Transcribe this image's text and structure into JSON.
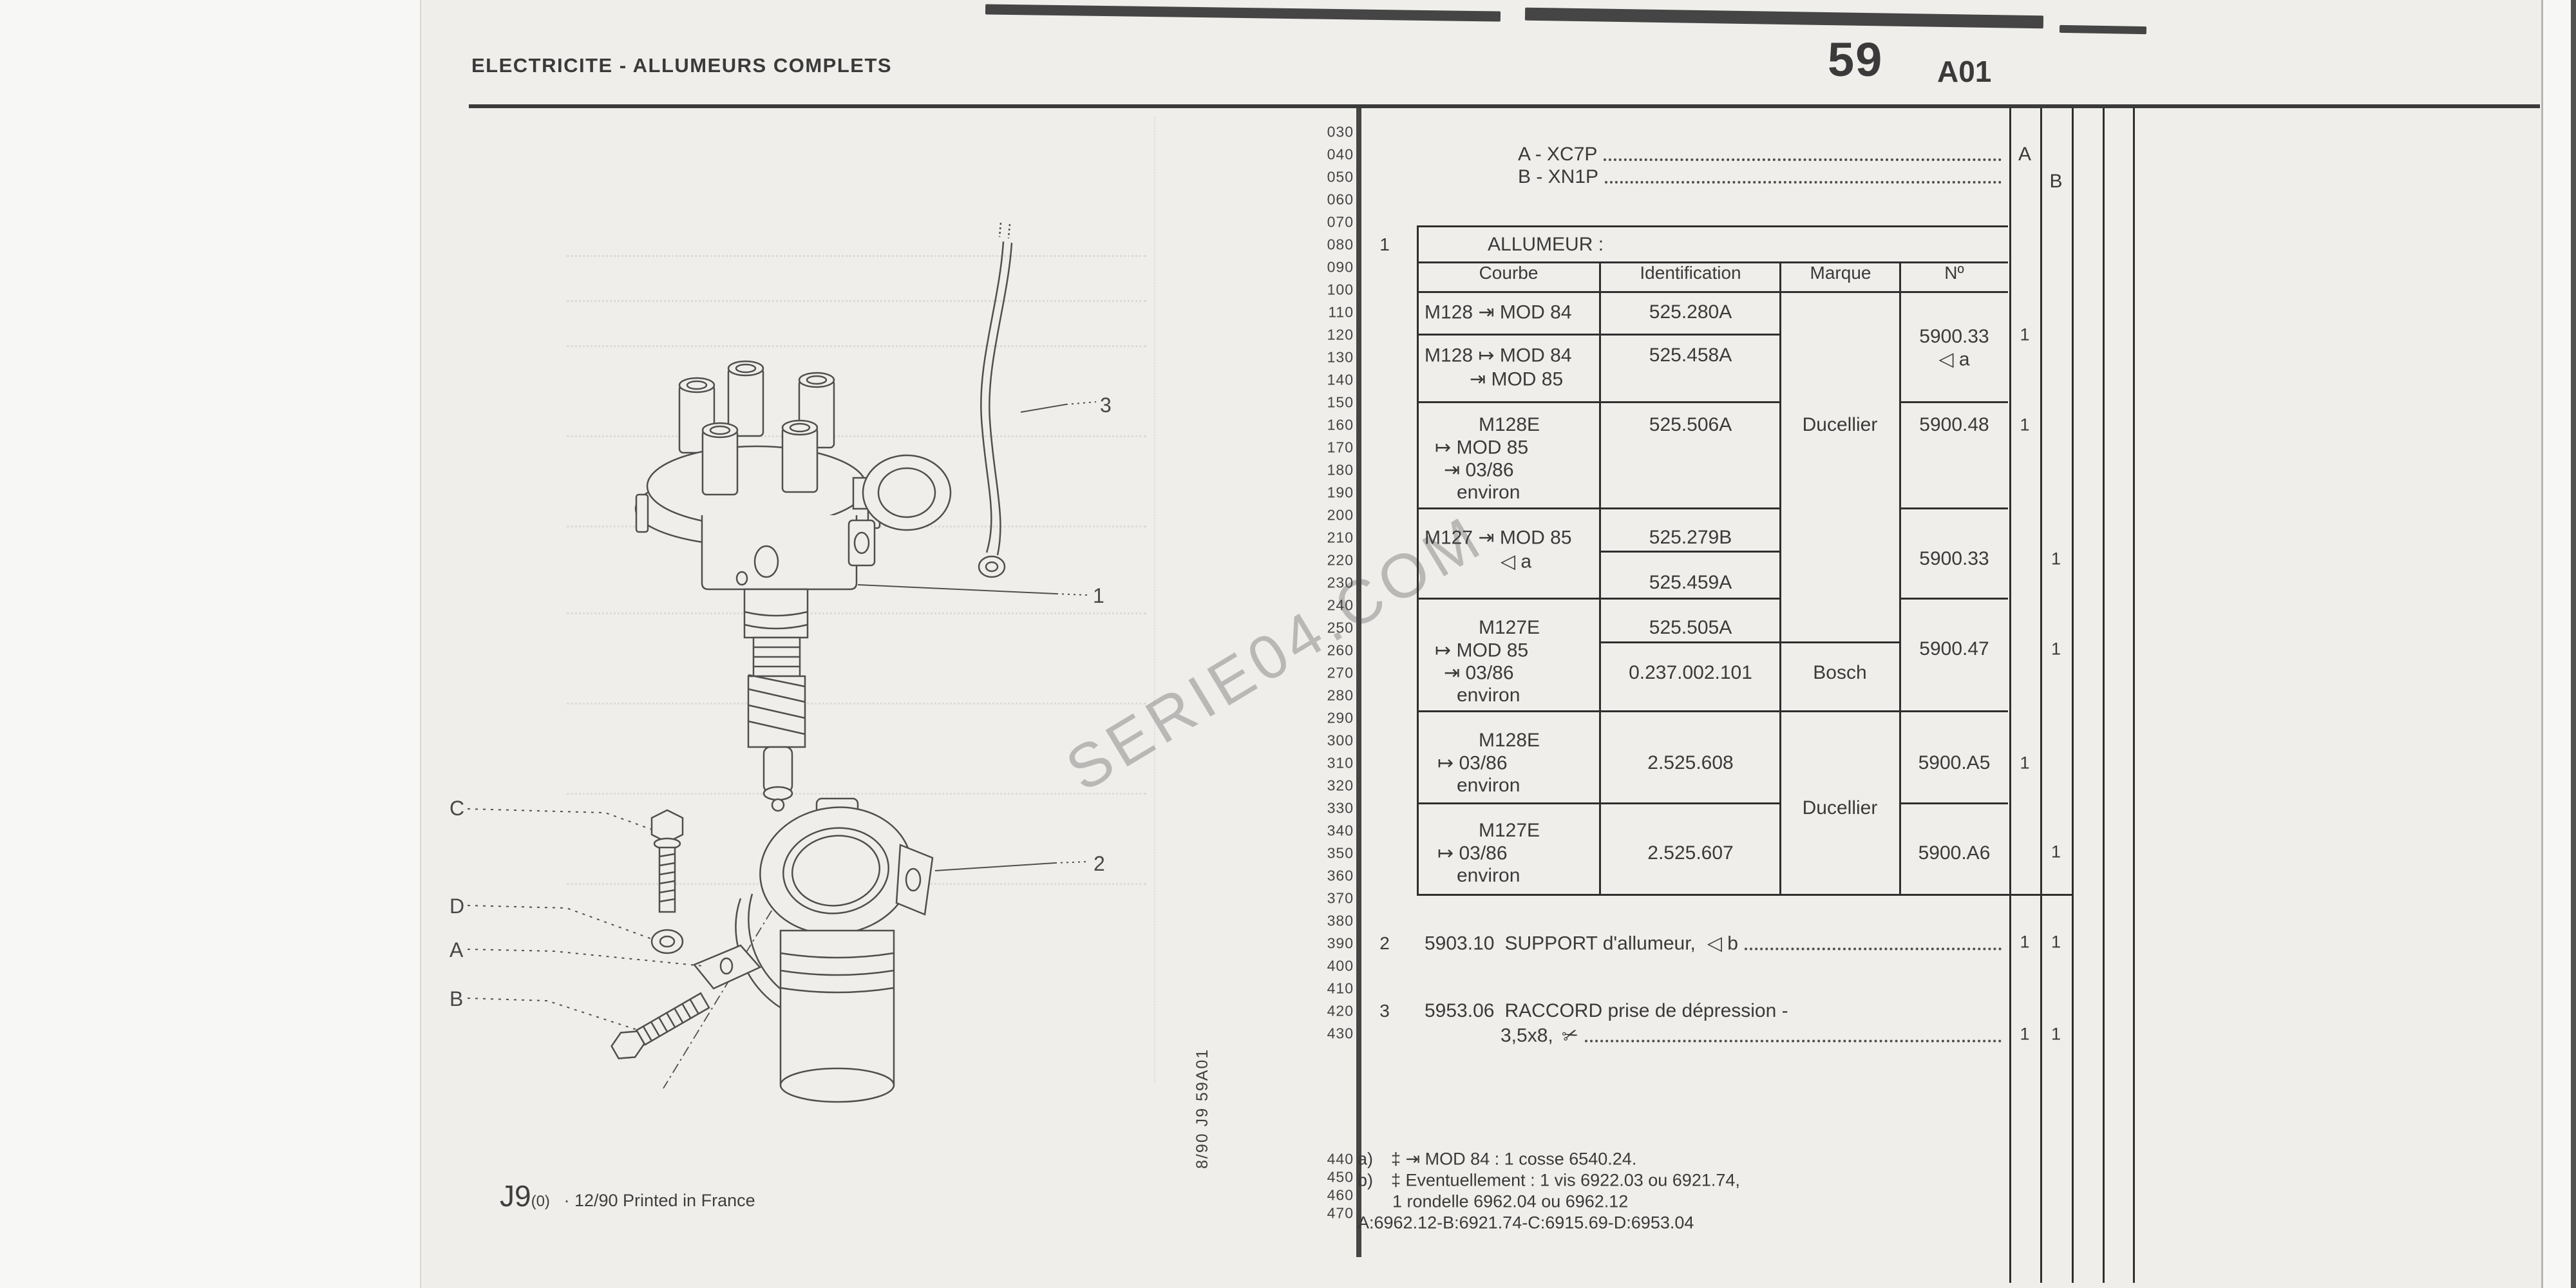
{
  "header": {
    "title": "ELECTRICITE - ALLUMEURS COMPLETS",
    "page_number": "59",
    "page_code": "A01"
  },
  "gutter": [
    "030",
    "040",
    "050",
    "060",
    "070",
    "080",
    "090",
    "100",
    "110",
    "120",
    "130",
    "140",
    "150",
    "160",
    "170",
    "180",
    "190",
    "200",
    "210",
    "220",
    "230",
    "240",
    "250",
    "260",
    "270",
    "280",
    "290",
    "300",
    "310",
    "320",
    "330",
    "340",
    "350",
    "360",
    "370",
    "380",
    "390",
    "400",
    "410",
    "420",
    "430"
  ],
  "gutter_bottom": [
    "440",
    "450",
    "460",
    "470"
  ],
  "variants": {
    "row_a": "A - XC7P",
    "row_b": "B - XN1P",
    "col_a": "A",
    "col_b": "B"
  },
  "allumeur": {
    "item_no": "1",
    "title": "ALLUMEUR :",
    "headers": {
      "courbe": "Courbe",
      "identification": "Identification",
      "marque": "Marque",
      "num": "Nº"
    },
    "rows": [
      {
        "c0": "M128 ⇥ MOD 84",
        "id0": "525.280A"
      },
      {
        "c0": "M128 ↦ MOD 84",
        "c1": "⇥ MOD 85",
        "id0": "525.458A",
        "num": "5900.33",
        "num_note": "◁ a",
        "qty_a": "1"
      },
      {
        "c0": "M128E",
        "c1": "↦ MOD 85",
        "c2": "⇥ 03/86",
        "c3": "environ",
        "id0": "525.506A",
        "marque": "Ducellier",
        "num": "5900.48",
        "qty_a": "1"
      },
      {
        "c0": "M127 ⇥ MOD 85",
        "c1": "◁ a",
        "id0": "525.279B",
        "id1": "525.459A",
        "num": "5900.33",
        "qty_b": "1"
      },
      {
        "c0": "M127E",
        "c1": "↦ MOD 85",
        "c2": "⇥ 03/86",
        "c3": "environ",
        "id0": "525.505A",
        "id1": "0.237.002.101",
        "marque": "Bosch",
        "num": "5900.47",
        "qty_b": "1"
      },
      {
        "c0": "M128E",
        "c1": "↦ 03/86",
        "c2": "environ",
        "id0": "2.525.608",
        "marque": "Ducellier",
        "num": "5900.A5",
        "qty_a": "1"
      },
      {
        "c0": "M127E",
        "c1": "↦ 03/86",
        "c2": "environ",
        "id0": "2.525.607",
        "num": "5900.A6",
        "qty_b": "1"
      }
    ]
  },
  "item2": {
    "no": "2",
    "ref": "5903.10",
    "name": "SUPPORT d'allumeur,",
    "symbol": "◁ b",
    "qty_a": "1",
    "qty_b": "1"
  },
  "item3": {
    "no": "3",
    "ref": "5953.06",
    "name": "RACCORD prise de dépression -",
    "name2": "3,5x8,",
    "cut_icon": "✂",
    "qty_a": "1",
    "qty_b": "1"
  },
  "notes": {
    "a_prefix": "a)",
    "a_text": "‡  ⇥ MOD 84 : 1 cosse 6540.24.",
    "b_prefix": "b)",
    "b_text": "‡  Eventuellement : 1 vis 6922.03 ou 6921.74,",
    "line3": "1 rondelle 6962.04 ou 6962.12",
    "line4": "A:6962.12-B:6921.74-C:6915.69-D:6953.04"
  },
  "footer": {
    "code": "J9",
    "rev": "(0)",
    "text": "· 12/90 Printed in France"
  },
  "side_text": "8/90   J9   59A01",
  "watermark": "SERIE04.COM",
  "diagram_labels": {
    "n1": "1",
    "n2": "2",
    "n3": "3",
    "a": "A",
    "b": "B",
    "c": "C",
    "d": "D"
  }
}
